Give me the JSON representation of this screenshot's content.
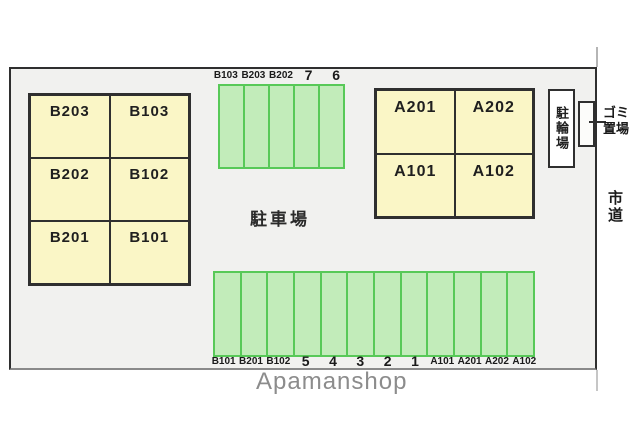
{
  "labels": {
    "parking_lot": "駐車場",
    "bicycle_parking": "駐輪場",
    "garbage_area": "ゴミ置場",
    "city_road": "市道"
  },
  "building_b": {
    "cells": [
      "B203",
      "B103",
      "B202",
      "B102",
      "B201",
      "B101"
    ]
  },
  "building_a": {
    "cells": [
      "A201",
      "A202",
      "A101",
      "A102"
    ]
  },
  "top_parking": {
    "stall_count": 5,
    "labels": [
      "B103",
      "B203",
      "B202",
      "7",
      "6"
    ]
  },
  "bottom_parking": {
    "stall_count": 12,
    "labels": [
      "B101",
      "B201",
      "B102",
      "5",
      "4",
      "3",
      "2",
      "1",
      "A101",
      "A201",
      "A202",
      "A102"
    ]
  },
  "watermark": "Apamanshop",
  "colors": {
    "site_fill": "#F1F1EF",
    "site_border": "#2F2F2F",
    "site_bottom_border": "#8A8A8A",
    "building_fill": "#FAF6C6",
    "stall_fill": "#C2ECBA",
    "stall_border": "#58C958",
    "watermark_text": "#8C8C8C"
  }
}
